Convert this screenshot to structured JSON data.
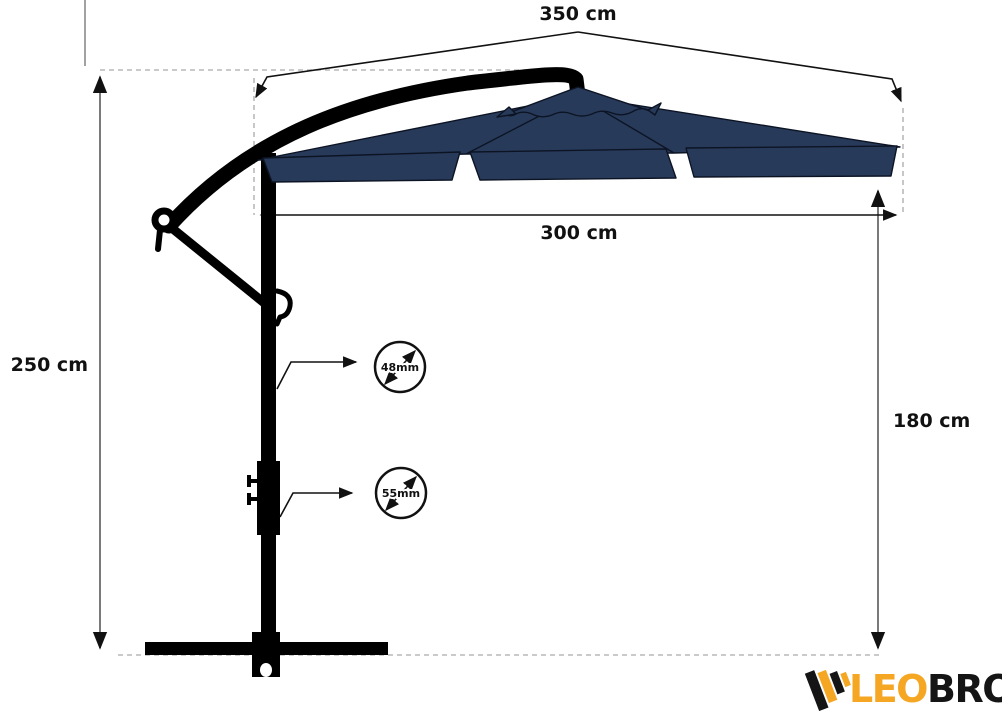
{
  "colors": {
    "bg": "#ffffff",
    "ink": "#111111",
    "canopy": "#283a5a",
    "dim-line": "#7a7a7a",
    "dash": "#b9b9b9",
    "logo-orange": "#f5a623",
    "logo-ink": "#151515"
  },
  "labels": {
    "width_overall": "350 cm",
    "width_canopy": "300 cm",
    "height_overall": "250 cm",
    "height_clearance": "180 cm",
    "pole_upper_diameter": "48mm",
    "pole_lower_diameter": "55mm"
  },
  "logo": {
    "text_primary": "LEO",
    "text_secondary": "BRO"
  }
}
